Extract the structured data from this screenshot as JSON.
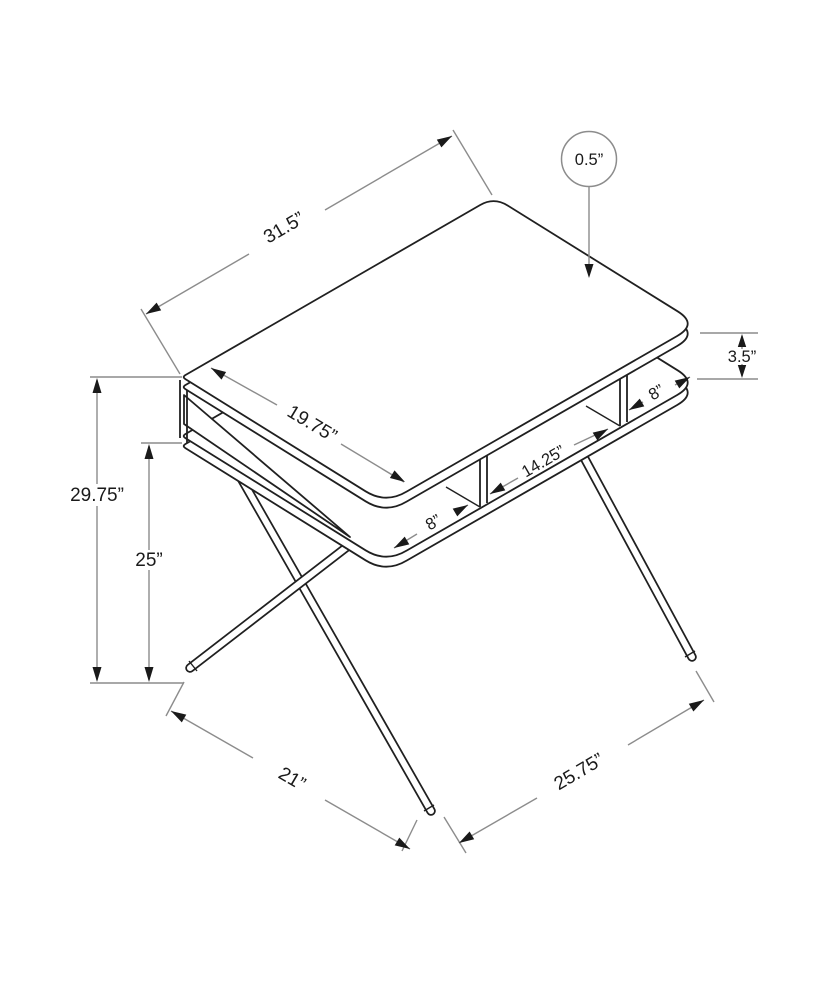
{
  "diagram": {
    "kind": "furniture-dimension-drawing",
    "subject": "computer desk with open shelf cubbies and crossed metal legs",
    "units": "inches",
    "colors": {
      "background": "#ffffff",
      "object_line": "#202020",
      "dimension_line": "#8c8c8c",
      "arrowhead": "#1a1a1a",
      "text": "#1a1a1a"
    },
    "dimensions": {
      "top_length": {
        "label": "31.5”",
        "value": 31.5,
        "measures": "desktop length along rear edge"
      },
      "top_thickness": {
        "label": "0.5”",
        "value": 0.5,
        "measures": "desktop panel thickness (circle callout)"
      },
      "top_depth": {
        "label": "19.75”",
        "value": 19.75,
        "measures": "desktop depth"
      },
      "cubby_left": {
        "label": "8”",
        "value": 8,
        "measures": "left cubby opening width"
      },
      "cubby_middle": {
        "label": "14.25”",
        "value": 14.25,
        "measures": "middle cubby opening width"
      },
      "cubby_right": {
        "label": "8”",
        "value": 8,
        "measures": "right cubby opening width"
      },
      "cubby_height": {
        "label": "3.5”",
        "value": 3.5,
        "measures": "gap between desktop and shelf"
      },
      "overall_height": {
        "label": "29.75”",
        "value": 29.75,
        "measures": "floor to desktop top"
      },
      "shelf_height": {
        "label": "25”",
        "value": 25,
        "measures": "floor to shelf"
      },
      "foot_spread_side": {
        "label": "21”",
        "value": 21,
        "measures": "left leg foot spread"
      },
      "foot_spread_front": {
        "label": "25.75”",
        "value": 25.75,
        "measures": "front-to-rear foot spread"
      }
    }
  }
}
